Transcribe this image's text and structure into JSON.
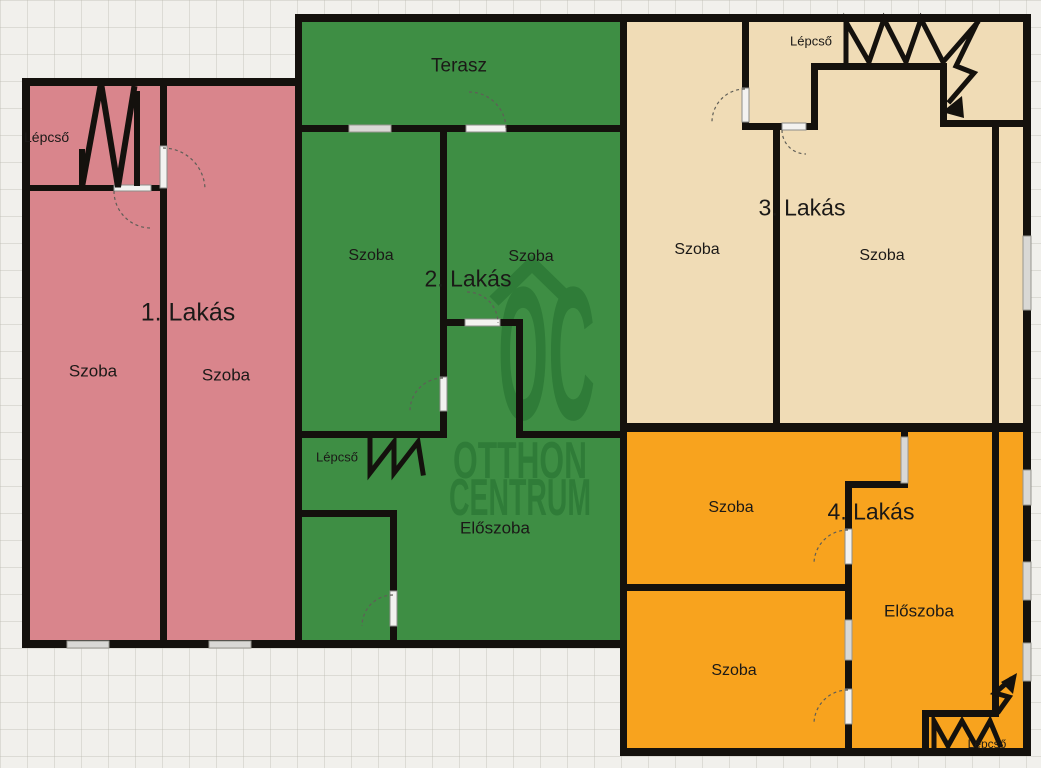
{
  "floorplan": {
    "background_color": "#f1f0ec",
    "wall_color": "#14110d",
    "watermark": {
      "logo": "OC",
      "line1": "OTTHON",
      "line2": "CENTRUM",
      "color": "#2f7c38"
    },
    "apartments": [
      {
        "name": "1. Lakás",
        "color": "#d9858c",
        "rooms": {
          "room1": "Szoba",
          "room2": "Szoba"
        },
        "stairs": "Lépcső"
      },
      {
        "name": "2. Lakás",
        "color": "#3e8e44",
        "rooms": {
          "terrace": "Terasz",
          "room1": "Szoba",
          "room2": "Szoba",
          "hall": "Előszoba"
        },
        "stairs": "Lépcső"
      },
      {
        "name": "3. Lakás",
        "color": "#f0dcb6",
        "rooms": {
          "room1": "Szoba",
          "room2": "Szoba"
        },
        "stairs": "Lépcső"
      },
      {
        "name": "4. Lakás",
        "color": "#f8a31e",
        "rooms": {
          "room1": "Szoba",
          "room2": "Szoba",
          "hall": "Előszoba"
        },
        "stairs": "Lépcső"
      }
    ]
  }
}
